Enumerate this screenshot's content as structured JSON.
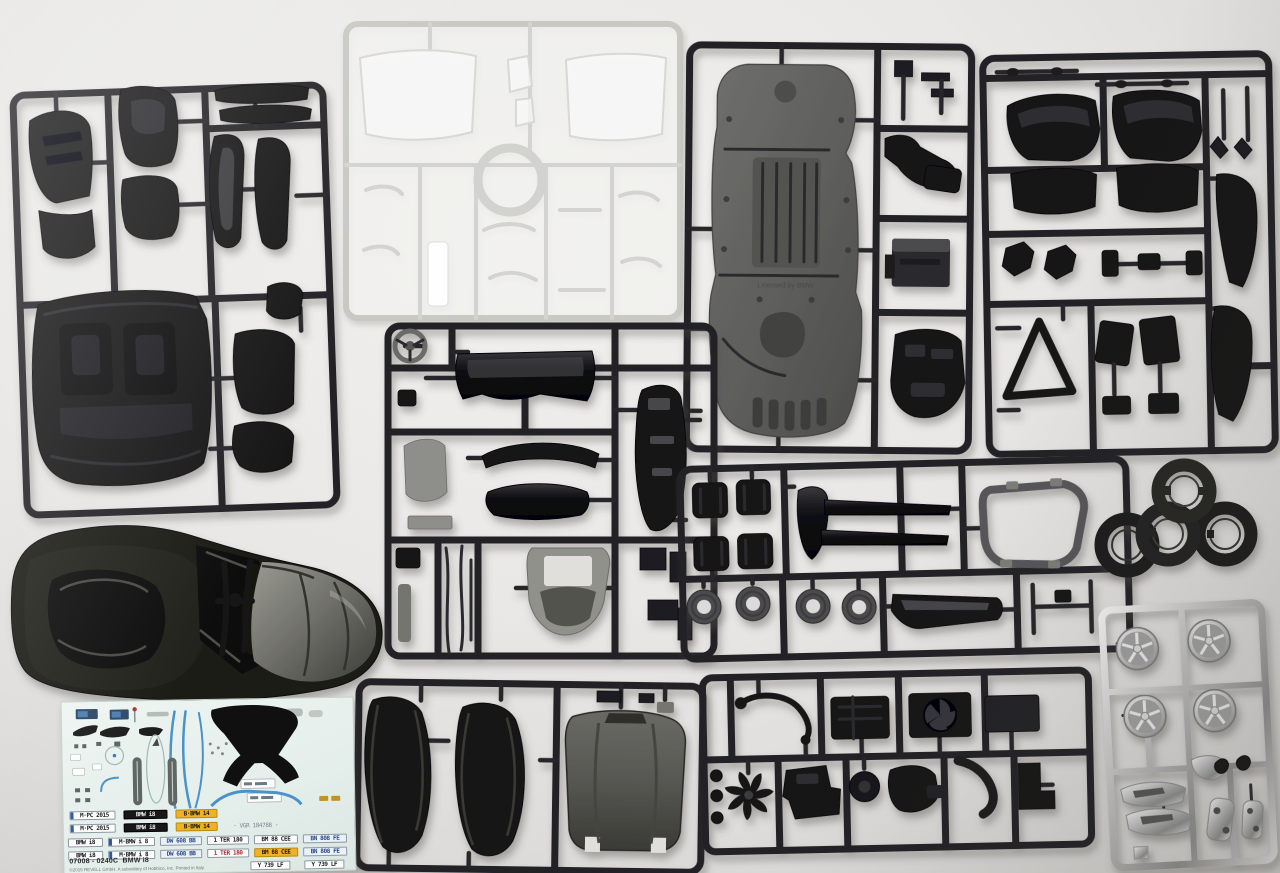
{
  "scene": {
    "description": "Unassembled Revell 1:24 BMW i8 plastic model kit: dark grey sprues, clear glazing sprue, chrome wheel sprue, tires, painted body shell and waterslide decal sheet laid out on a white table"
  },
  "chassis_sprue": {
    "molded_text": "Licensed by BMW"
  },
  "decal_sheet": {
    "kit_number": "07008 - 0240C",
    "kit_name": "BMW i8",
    "copyright": "©2015 REVELL GmbH. A subsidiary of Hobbico, Inc. Printed in Italy",
    "rows": [
      {
        "plates": [
          "M·PC 2015",
          "BMW i8",
          "B·BMW 14"
        ]
      },
      {
        "plates": [
          "M·PC 2015",
          "BMW i8",
          "B·BMW 14",
          "· VGR 184788 ·"
        ]
      },
      {
        "plates": [
          "BMW i8",
          "M·BMW i 8",
          "DW 608 BB",
          "1 TER 180",
          "BM 88 CEE",
          "BN 808 FE"
        ]
      },
      {
        "plates": [
          "BMW i8",
          "M·BMW i 8",
          "DW 608 BB",
          "1 TER 180",
          "BM 88 CEE",
          "BN 808 FE"
        ]
      }
    ],
    "bottom_plates": [
      "Y 739 LF",
      "Y 739 LF"
    ]
  },
  "colors": {
    "background": "#e9e8e6",
    "dark_plastic": "#131316",
    "grey_plastic": "#8e8e8a",
    "chrome": "#d9d9d9",
    "decal_paper": "#e8f1ed",
    "decal_blue": "#4a92c8",
    "plate_orange": "#f0b225"
  }
}
